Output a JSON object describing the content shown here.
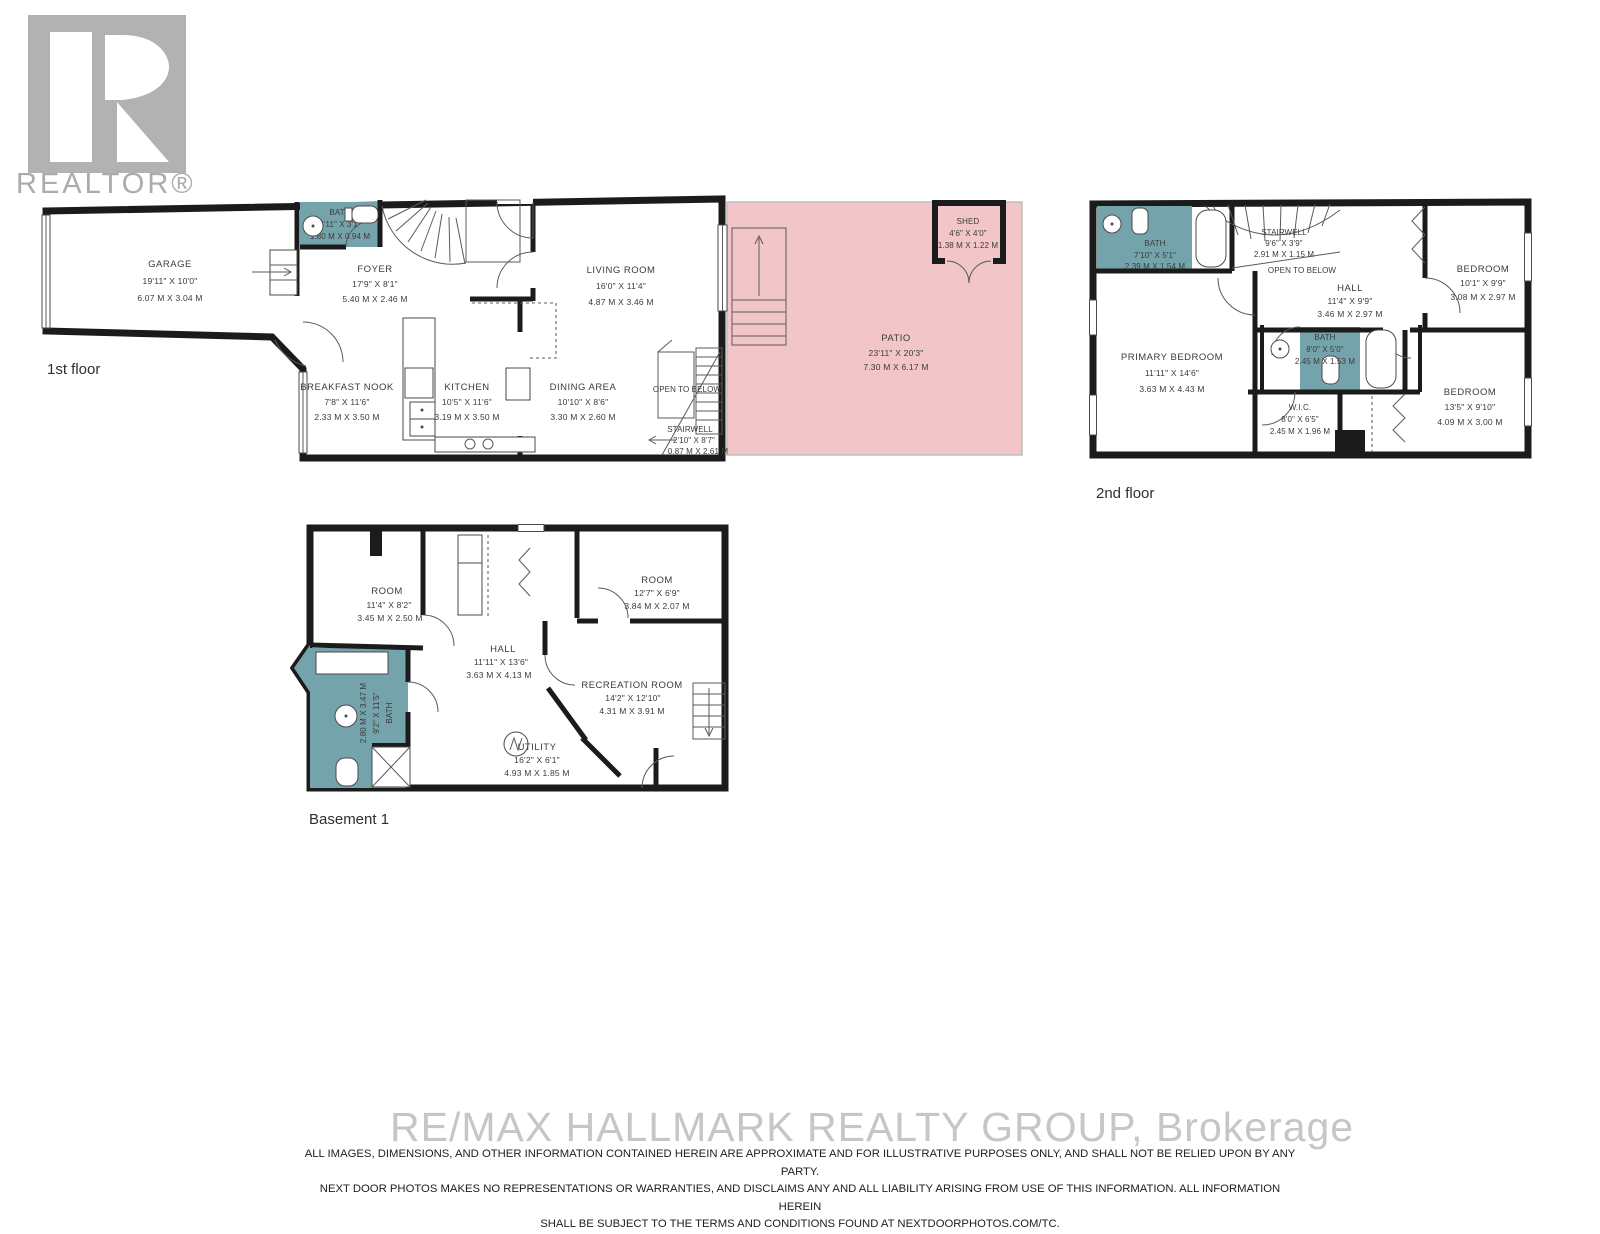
{
  "logo": {
    "realtor_text": "REALTOR®"
  },
  "colors": {
    "floor": "#eceade",
    "wall": "#1b1b1b",
    "bath_teal": "#74a3ac",
    "patio_pink": "#f2c5c8",
    "watermark_gray": "#c6c6c6"
  },
  "floors": {
    "first": {
      "label": "1st floor",
      "rooms": {
        "garage": {
          "name": "GARAGE",
          "ft": "19'11\" X 10'0\"",
          "m": "6.07 M X 3.04 M"
        },
        "bath": {
          "name": "BATH",
          "ft": "5'11\" X 3'1\"",
          "m": "1.80 M X 0.94 M"
        },
        "foyer": {
          "name": "FOYER",
          "ft": "17'9\" X 8'1\"",
          "m": "5.40 M X 2.46 M"
        },
        "living": {
          "name": "LIVING ROOM",
          "ft": "16'0\" X 11'4\"",
          "m": "4.87 M X 3.46 M"
        },
        "breakfast": {
          "name": "BREAKFAST NOOK",
          "ft": "7'8\" X 11'6\"",
          "m": "2.33 M X 3.50 M"
        },
        "kitchen": {
          "name": "KITCHEN",
          "ft": "10'5\" X 11'6\"",
          "m": "3.19 M X 3.50 M"
        },
        "dining": {
          "name": "DINING AREA",
          "ft": "10'10\" X 8'6\"",
          "m": "3.30 M X 2.60 M"
        },
        "open_below": {
          "name": "OPEN TO BELOW"
        },
        "stairwell": {
          "name": "STAIRWELL",
          "ft": "2'10\" X 8'7\"",
          "m": "0.87 M X 2.61 M"
        },
        "patio": {
          "name": "PATIO",
          "ft": "23'11\" X 20'3\"",
          "m": "7.30 M X 6.17 M"
        },
        "shed": {
          "name": "SHED",
          "ft": "4'6\" X 4'0\"",
          "m": "1.38 M X 1.22 M"
        }
      }
    },
    "second": {
      "label": "2nd floor",
      "rooms": {
        "bath_top": {
          "name": "BATH",
          "ft": "7'10\" X 5'1\"",
          "m": "2.39 M X 1.54 M"
        },
        "stairwell": {
          "name": "STAIRWELL",
          "ft": "9'6\" X 3'9\"",
          "m": "2.91 M X 1.15 M"
        },
        "open_below": {
          "name": "OPEN TO BELOW"
        },
        "primary": {
          "name": "PRIMARY BEDROOM",
          "ft": "11'11\" X 14'6\"",
          "m": "3.63 M X 4.43 M"
        },
        "hall": {
          "name": "HALL",
          "ft": "11'4\" X 9'9\"",
          "m": "3.46 M X 2.97 M"
        },
        "bedroom_top": {
          "name": "BEDROOM",
          "ft": "10'1\" X 9'9\"",
          "m": "3.08 M X 2.97 M"
        },
        "bath_mid": {
          "name": "BATH",
          "ft": "8'0\" X 5'0\"",
          "m": "2.45 M X 1.53 M"
        },
        "wic": {
          "name": "W.I.C.",
          "ft": "8'0\" X 6'5\"",
          "m": "2.45 M X 1.96 M"
        },
        "bedroom_bot": {
          "name": "BEDROOM",
          "ft": "13'5\" X 9'10\"",
          "m": "4.09 M X 3.00 M"
        }
      }
    },
    "basement": {
      "label": "Basement 1",
      "rooms": {
        "room_left": {
          "name": "ROOM",
          "ft": "11'4\" X 8'2\"",
          "m": "3.45 M X 2.50 M"
        },
        "hall": {
          "name": "HALL",
          "ft": "11'11\" X 13'6\"",
          "m": "3.63 M X 4.13 M"
        },
        "room_right": {
          "name": "ROOM",
          "ft": "12'7\" X 6'9\"",
          "m": "3.84 M X 2.07 M"
        },
        "bath": {
          "name": "BATH",
          "ft": "9'2\" X 11'5\"",
          "m": "2.80 M X 3.47 M"
        },
        "recreation": {
          "name": "RECREATION ROOM",
          "ft": "14'2\" X 12'10\"",
          "m": "4.31 M X 3.91 M"
        },
        "utility": {
          "name": "UTILITY",
          "ft": "16'2\" X 6'1\"",
          "m": "4.93 M X 1.85 M"
        }
      }
    }
  },
  "footer": {
    "watermark": "RE/MAX HALLMARK REALTY GROUP, Brokerage",
    "disclaimer_line1": "ALL IMAGES, DIMENSIONS, AND OTHER INFORMATION CONTAINED HEREIN ARE APPROXIMATE AND FOR ILLUSTRATIVE PURPOSES ONLY, AND SHALL NOT BE RELIED UPON BY ANY PARTY.",
    "disclaimer_line2": "NEXT DOOR PHOTOS MAKES NO REPRESENTATIONS OR WARRANTIES, AND DISCLAIMS ANY AND ALL LIABILITY ARISING FROM USE OF THIS INFORMATION. ALL INFORMATION HEREIN",
    "disclaimer_line3": "SHALL BE SUBJECT TO THE TERMS AND CONDITIONS FOUND AT NEXTDOORPHOTOS.COM/TC."
  }
}
